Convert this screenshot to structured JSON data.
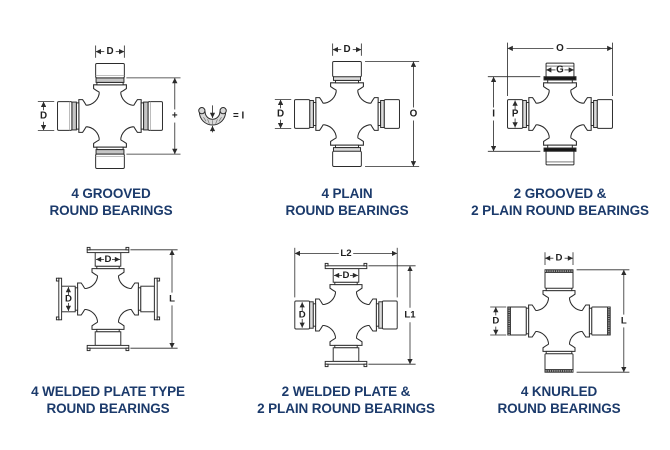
{
  "page": {
    "background": "#ffffff"
  },
  "colors": {
    "caption": "#1b3a6b",
    "line": "#2b2b2b",
    "collar_gray": "#c6c6c6",
    "band_gray": "#dcdcdc",
    "ring_black": "#151515"
  },
  "diagrams": [
    {
      "id": "four-grooved",
      "caption": [
        "4 GROOVED",
        "ROUND BEARINGS"
      ],
      "dims": {
        "top": "D",
        "left": "D",
        "right_plus": "+",
        "ring_equals": "= I"
      }
    },
    {
      "id": "four-plain",
      "caption": [
        "4 PLAIN",
        "ROUND BEARINGS"
      ],
      "dims": {
        "top": "D",
        "left": "D",
        "right": "O"
      }
    },
    {
      "id": "two-grooved-two-plain",
      "caption": [
        "2 GROOVED &",
        "2 PLAIN ROUND BEARINGS"
      ],
      "dims": {
        "top": "O",
        "top_cap": "G",
        "left": "I",
        "left_cap": "P"
      }
    },
    {
      "id": "four-welded-plate",
      "caption": [
        "4 WELDED PLATE TYPE",
        "ROUND BEARINGS"
      ],
      "dims": {
        "top_cap": "D",
        "left_cap": "D",
        "right": "L"
      }
    },
    {
      "id": "two-welded-two-plain",
      "caption": [
        "2 WELDED PLATE &",
        "2 PLAIN ROUND BEARINGS"
      ],
      "dims": {
        "top": "L2",
        "top_cap": "D",
        "left_cap": "D",
        "right": "L1"
      }
    },
    {
      "id": "four-knurled",
      "caption": [
        "4 KNURLED",
        "ROUND BEARINGS"
      ],
      "dims": {
        "top": "D",
        "left": "D",
        "right": "L"
      }
    }
  ]
}
